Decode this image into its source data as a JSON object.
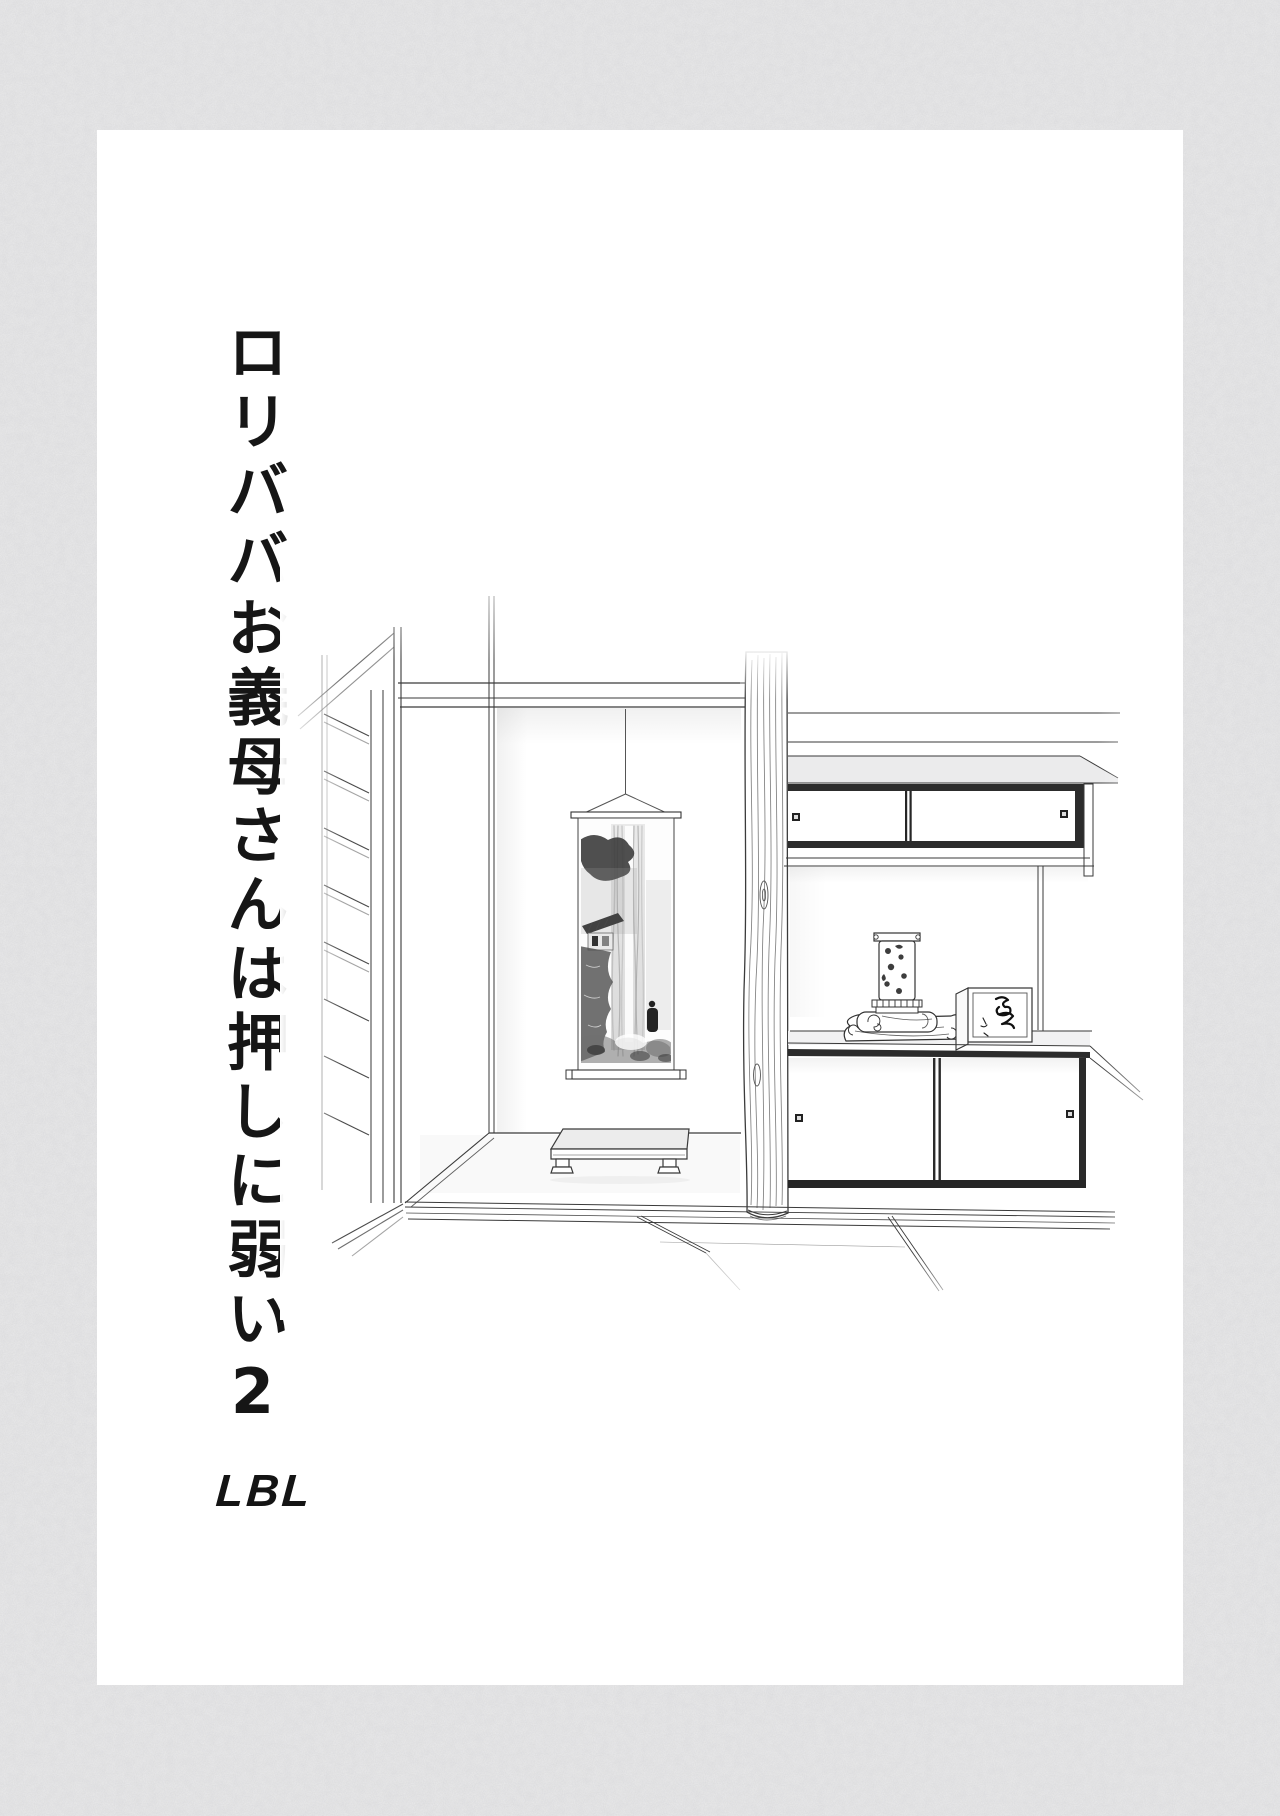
{
  "page": {
    "background": "#e6e6e7",
    "paper": "#ffffff",
    "ink": "#1a1a1a"
  },
  "cover": {
    "title_vertical": "ロリババお義母さんは押しに弱い2",
    "artist_credit": "LBL"
  },
  "illustration": {
    "style": "monochrome line art",
    "subject": "Japanese tatami room with tokonoma alcove",
    "parts": [
      "slatted window shutter",
      "ceiling beam",
      "hanging scroll with ink waterfall landscape",
      "low display table",
      "natural wood alcove pillar",
      "upper sliding-door cabinet",
      "display shelf with ornate lamp, folded cloth and inscribed wooden box",
      "lower sliding-door cabinet",
      "tatami floor"
    ]
  }
}
